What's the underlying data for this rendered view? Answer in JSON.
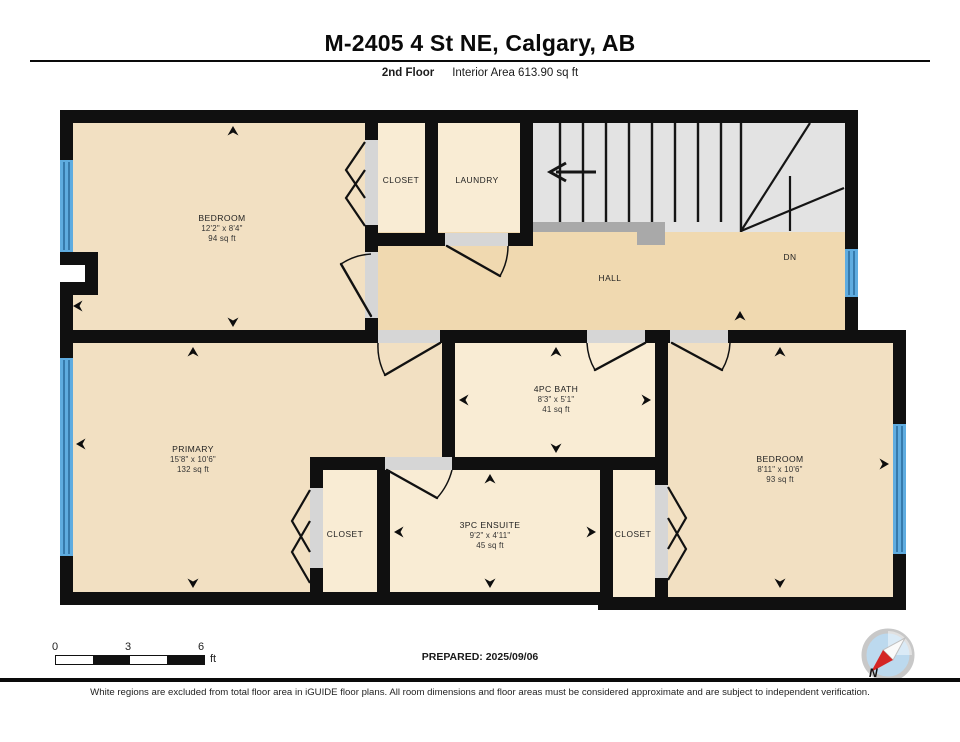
{
  "header": {
    "title": "M-2405 4 St NE, Calgary, AB",
    "floor_label": "2nd Floor",
    "area_label": "Interior Area 613.90 sq ft"
  },
  "rooms": {
    "bedroom_tl": {
      "name": "BEDROOM",
      "dims": "12'2\" x 8'4\"",
      "area": "94 sq ft"
    },
    "closet_top": {
      "name": "CLOSET"
    },
    "laundry": {
      "name": "LAUNDRY"
    },
    "hall": {
      "name": "HALL"
    },
    "stairs": {
      "down_label": "DN"
    },
    "primary": {
      "name": "PRIMARY",
      "dims": "15'8\" x 10'6\"",
      "area": "132 sq ft"
    },
    "bath": {
      "name": "4PC BATH",
      "dims": "8'3\" x 5'1\"",
      "area": "41 sq ft"
    },
    "ensuite": {
      "name": "3PC ENSUITE",
      "dims": "9'2\" x 4'11\"",
      "area": "45 sq ft"
    },
    "closet_left": {
      "name": "CLOSET"
    },
    "closet_right": {
      "name": "CLOSET"
    },
    "bedroom_right": {
      "name": "BEDROOM",
      "dims": "8'11\" x 10'6\"",
      "area": "93 sq ft"
    }
  },
  "footer": {
    "scale_start": "0",
    "scale_mid": "3",
    "scale_end": "6",
    "scale_unit": "ft",
    "prepared": "PREPARED: 2025/09/06",
    "compass_north": "N"
  },
  "disclaimer": "White regions are excluded from total floor area in iGUIDE floor plans. All room dimensions and floor areas must be considered approximate and are subject to independent verification.",
  "colors": {
    "wall": "#101010",
    "floor_tan": "#f2e0c2",
    "floor_cream": "#f9ecd4",
    "floor_hall": "#f0d9b0",
    "floor_stairs": "#e3e3e3",
    "stair_nosing": "#a9a9a9",
    "door_gap": "#d6d6d6",
    "window_blue": "#5face0",
    "window_stripe": "#2d6e9e",
    "compass_red": "#d42525",
    "compass_blue": "#bcd9ee"
  }
}
